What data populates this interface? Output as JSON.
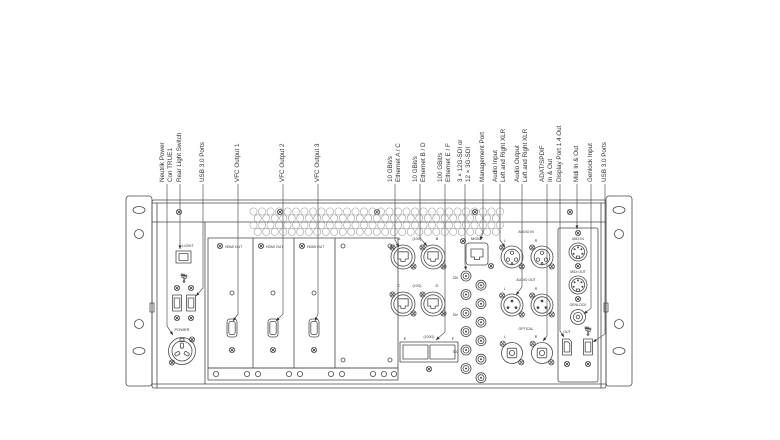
{
  "callouts": [
    {
      "x": 167,
      "lines": [
        "Neutrik Power",
        "Con TRUE1"
      ],
      "points": "167,184 167,326 173,335"
    },
    {
      "x": 180,
      "lines": [
        "Rear Light Switch"
      ],
      "points": "180,184 180,249"
    },
    {
      "x": 203,
      "lines": [
        "USB 3.0 Ports"
      ],
      "points": "203,184 203,288 196,296"
    },
    {
      "x": 238,
      "lines": [
        "VFC Output 1"
      ],
      "points": "238,184 238,314 233,321"
    },
    {
      "x": 283,
      "lines": [
        "VFC Output 2"
      ],
      "points": "283,184 283,314 276,321"
    },
    {
      "x": 318,
      "lines": [
        "VFC Output 3"
      ],
      "points": "318,184 318,314 315,321"
    },
    {
      "x": 395,
      "lines": [
        "10 GBit/s",
        "Ethernet A / C"
      ],
      "points": "395,184 395,240 399,247"
    },
    {
      "x": 420,
      "lines": [
        "10 GBit/s",
        "Ethernet B / D"
      ],
      "points": "420,184 420,238 427,246"
    },
    {
      "x": 445,
      "lines": [
        "100 GBit/s",
        "Ethernet E / F"
      ],
      "points": "445,184 445,332 436,340"
    },
    {
      "x": 465,
      "lines": [
        "3 × 12G-SDI or",
        "12 × 3G-SDI"
      ],
      "points": "465,184 465,264 466,270"
    },
    {
      "x": 483,
      "lines": [
        "Management Port"
      ],
      "points": "483,184 483,233 480,240"
    },
    {
      "x": 500,
      "lines": [
        "Audio Input",
        "Left and Right XLR"
      ],
      "points": "500,184 500,240 505,247"
    },
    {
      "x": 522,
      "lines": [
        "Audio Output",
        "Left and Right XLR"
      ],
      "points": "522,184 522,287 516,295"
    },
    {
      "x": 547,
      "lines": [
        "ADAT/SPDIF",
        "In & Out"
      ],
      "points": "547,184 547,336 543,341"
    },
    {
      "x": 560,
      "lines": [
        "Display Port 1.4 Out"
      ],
      "points": "560,184 560,331 564,337"
    },
    {
      "x": 577,
      "lines": [
        "Midi In & Out"
      ],
      "points": "577,184 577,229"
    },
    {
      "x": 591,
      "lines": [
        "Genlock Input"
      ],
      "points": "591,184 591,308 584,314"
    },
    {
      "x": 605,
      "lines": [
        "USB 3.0 Ports"
      ],
      "points": "605,184 605,334 593,342"
    }
  ],
  "panel": {
    "left": {
      "light": "LIGHT",
      "power": "POWER"
    },
    "cards": {
      "label": "HDMI OUT"
    },
    "network": {
      "a": "A",
      "b": "B",
      "c": "C",
      "d": "D",
      "ten_g": "(10G)",
      "hundred_g": "(100G)",
      "e": "E",
      "f": "F",
      "mgmt": "MGMT"
    },
    "sdi": {
      "label": "SDI"
    },
    "audio": {
      "in": "AUDIO IN",
      "out": "AUDIO OUT",
      "optical": "OPTICAL",
      "l": "L",
      "r": "R"
    },
    "right": {
      "midi_in": "MIDI IN",
      "midi_out": "MIDI OUT",
      "genlock": "GENLOCK",
      "dp": "OUT"
    }
  },
  "colors": {
    "line": "#4a4a4a",
    "leader": "#555555",
    "text": "#333333",
    "vent": "#999999"
  }
}
